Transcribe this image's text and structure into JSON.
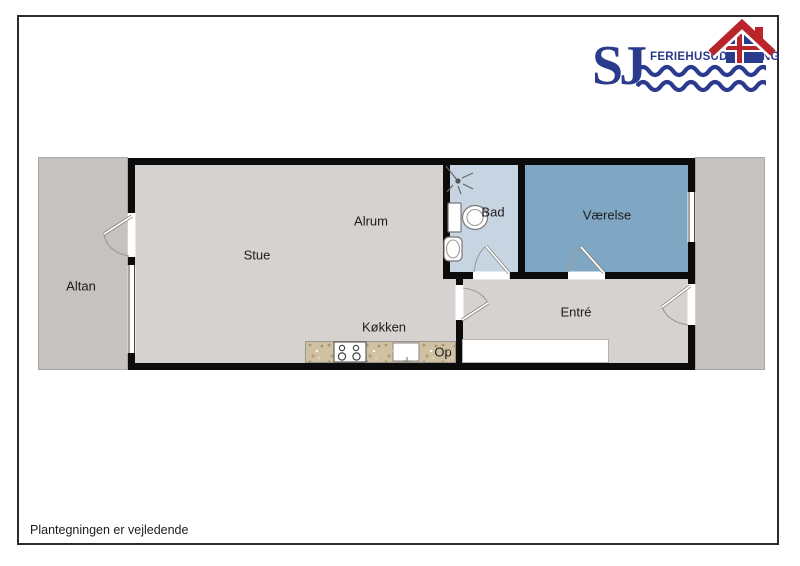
{
  "logo": {
    "monogram": "SJ",
    "brand_name": "FERIEHUSUDLEJNING",
    "navy_color": "#2a3a8c",
    "red_color": "#b9252b"
  },
  "floorplan": {
    "wall_color": "#0c0c0c",
    "floor_color": "#d6d2cf",
    "outdoor_color": "#c5c2bf",
    "bathroom_color": "#c7d4e2",
    "bedroom_color": "#7fa7c3",
    "counter_color": "#cfc1a2",
    "labels": {
      "altan": "Altan",
      "stue": "Stue",
      "alrum": "Alrum",
      "kokken": "Køkken",
      "op": "Op",
      "bad": "Bad",
      "vaerelse": "Værelse",
      "entre": "Entré"
    }
  },
  "footer": {
    "disclaimer": "Plantegningen er vejledende"
  }
}
